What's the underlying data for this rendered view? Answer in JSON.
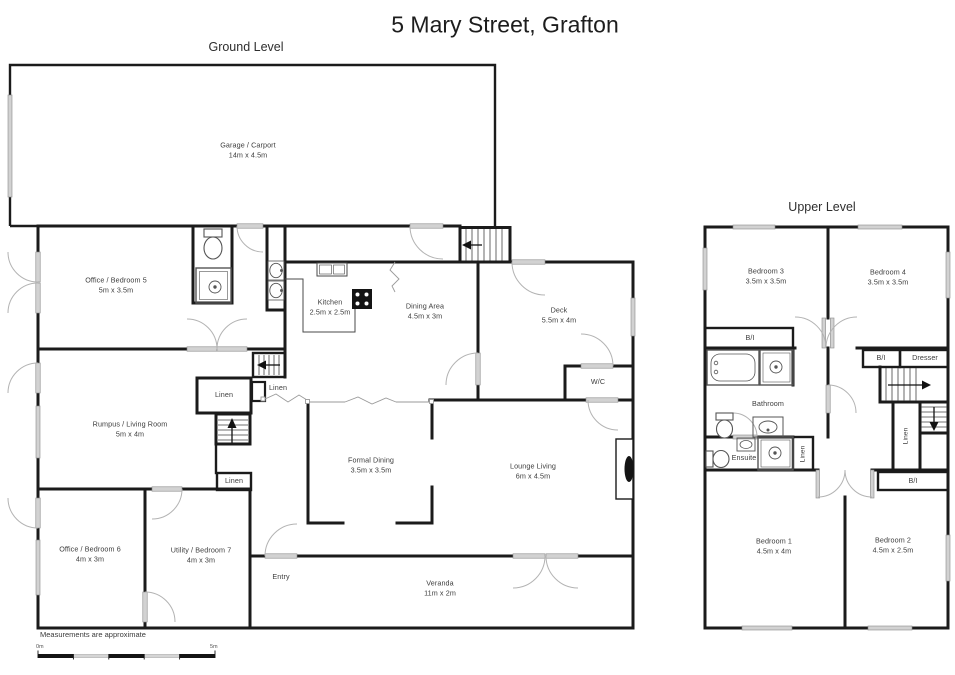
{
  "title": "5 Mary Street, Grafton",
  "ground": {
    "heading": "Ground Level",
    "rooms": {
      "garage": {
        "name": "Garage / Carport",
        "dims": "14m x 4.5m"
      },
      "office5": {
        "name": "Office / Bedroom 5",
        "dims": "5m x 3.5m"
      },
      "kitchen": {
        "name": "Kitchen",
        "dims": "2.5m x 2.5m"
      },
      "dining": {
        "name": "Dining Area",
        "dims": "4.5m x 3m"
      },
      "deck": {
        "name": "Deck",
        "dims": "5.5m x 4m"
      },
      "wc": {
        "name": "W/C"
      },
      "rumpus": {
        "name": "Rumpus / Living Room",
        "dims": "5m x 4m"
      },
      "formal_dining": {
        "name": "Formal Dining",
        "dims": "3.5m x 3.5m"
      },
      "lounge": {
        "name": "Lounge Living",
        "dims": "6m x 4.5m"
      },
      "office6": {
        "name": "Office / Bedroom 6",
        "dims": "4m x 3m"
      },
      "utility": {
        "name": "Utility / Bedroom 7",
        "dims": "4m x 3m"
      },
      "entry": {
        "name": "Entry"
      },
      "veranda": {
        "name": "Veranda",
        "dims": "11m x 2m"
      },
      "linen_hall": {
        "name": "Linen"
      },
      "linen_mid": {
        "name": "Linen"
      },
      "linen_lower": {
        "name": "Linen"
      }
    }
  },
  "upper": {
    "heading": "Upper Level",
    "rooms": {
      "bedroom3": {
        "name": "Bedroom 3",
        "dims": "3.5m x 3.5m"
      },
      "bedroom4": {
        "name": "Bedroom 4",
        "dims": "3.5m x 3.5m"
      },
      "bi_bed3": {
        "name": "B/I"
      },
      "bi_hall": {
        "name": "B/I"
      },
      "dresser": {
        "name": "Dresser"
      },
      "bathroom": {
        "name": "Bathroom"
      },
      "ensuite": {
        "name": "Ensuite"
      },
      "linen_left": {
        "name": "Linen"
      },
      "linen_right": {
        "name": "Linen"
      },
      "bi_bed2": {
        "name": "B/I"
      },
      "bedroom1": {
        "name": "Bedroom 1",
        "dims": "4.5m x 4m"
      },
      "bedroom2": {
        "name": "Bedroom 2",
        "dims": "4.5m x 2.5m"
      }
    }
  },
  "footer": {
    "note": "Measurements are approximate",
    "scale_start": "0m",
    "scale_end": "5m"
  },
  "colors": {
    "wall": "#1b1b1b",
    "label": "#3d3d3d",
    "door_arc": "#b3b3b3",
    "window_fill": "#d2d2d2"
  }
}
